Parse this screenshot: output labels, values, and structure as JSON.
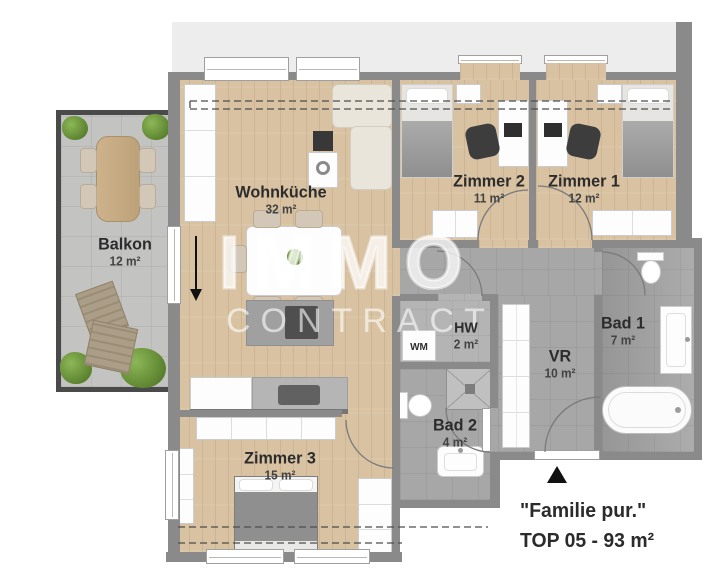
{
  "watermark": {
    "line1": "IMMO",
    "line2": "CONTRACT"
  },
  "rooms": {
    "balkon": {
      "name": "Balkon",
      "area": "12 m²"
    },
    "wohnkueche": {
      "name": "Wohnküche",
      "area": "32 m²"
    },
    "zimmer2": {
      "name": "Zimmer 2",
      "area": "11 m²"
    },
    "zimmer1": {
      "name": "Zimmer 1",
      "area": "12 m²"
    },
    "zimmer3": {
      "name": "Zimmer 3",
      "area": "15 m²"
    },
    "hw": {
      "name": "HW",
      "area": "2 m²"
    },
    "bad2": {
      "name": "Bad 2",
      "area": "4 m²"
    },
    "vr": {
      "name": "VR",
      "area": "10 m²"
    },
    "bad1": {
      "name": "Bad 1",
      "area": "7 m²"
    }
  },
  "appliances": {
    "washing_machine": "WM"
  },
  "footer": {
    "tagline": "\"Familie pur.\"",
    "unit": "TOP 05 - 93 m²"
  },
  "palette": {
    "wood": "#d8c2a2",
    "tile": "#a7a7a7",
    "wall": "#8a8a8a",
    "balcony": "#c3c4c1",
    "building": "#ededee",
    "label": "#2c2c2c"
  }
}
